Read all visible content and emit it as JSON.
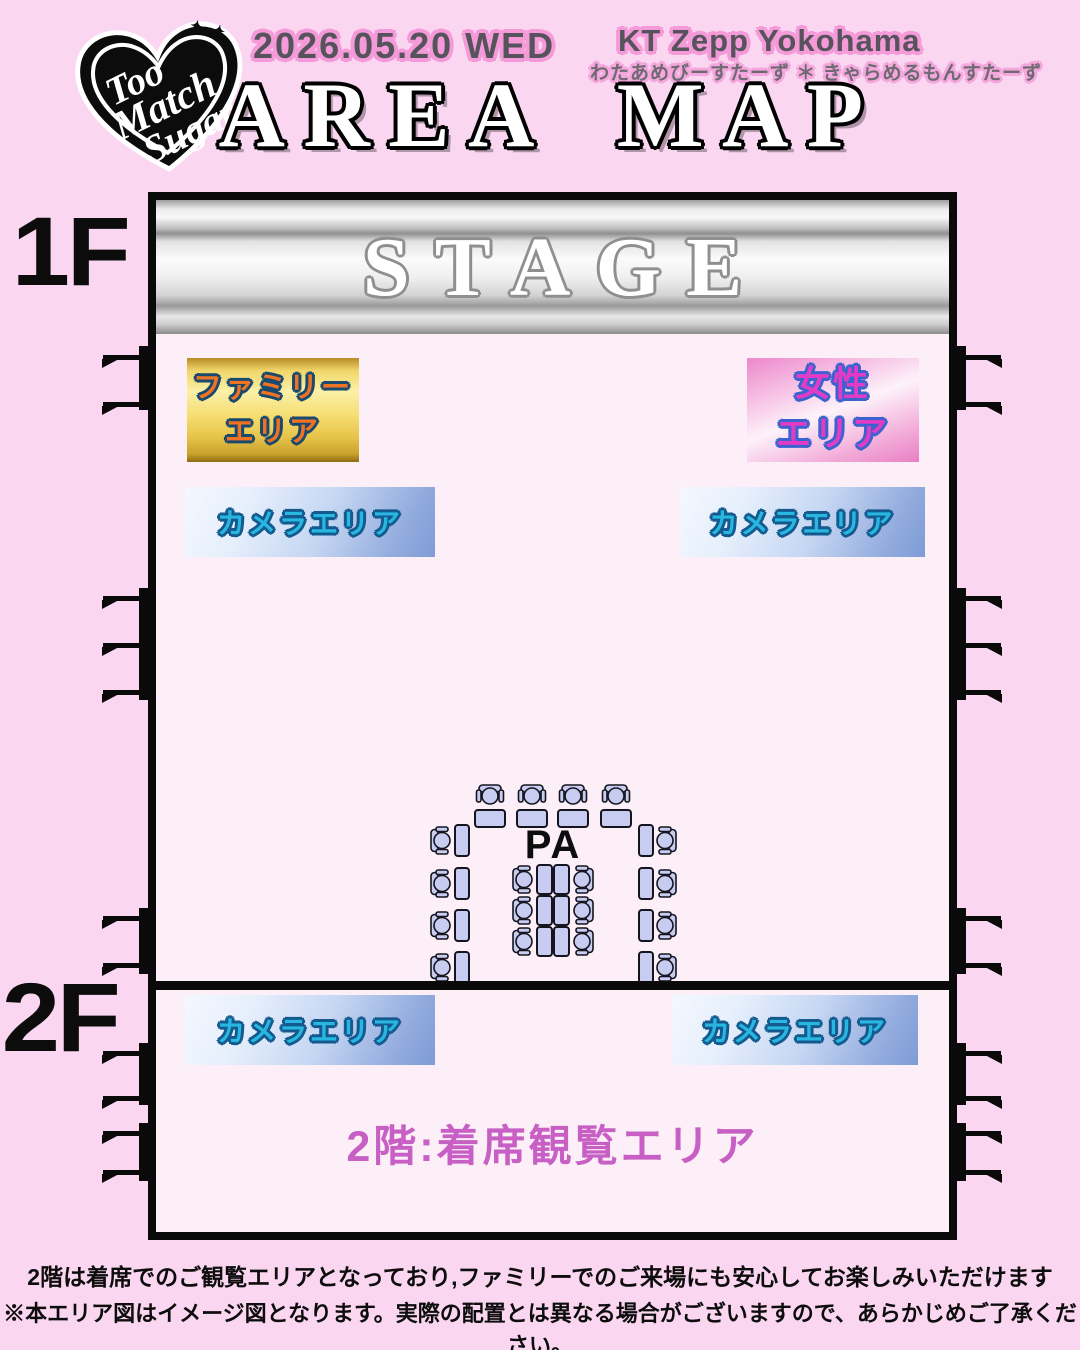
{
  "logo": {
    "lines": [
      "Too",
      "Match",
      "Sugar"
    ],
    "sparkles": "✦ ✦"
  },
  "header": {
    "date": "2026.05.20 WED",
    "venue": "KT Zepp Yokohama",
    "artists": "わたあめびーすたーず ＊ きゃらめるもんすたーず",
    "title": "AREA MAP"
  },
  "map": {
    "floor1_label": "1F",
    "floor2_label": "2F",
    "stage_label": "STAGE",
    "family_area": {
      "line1": "ファミリー",
      "line2": "エリア"
    },
    "women_area": {
      "line1": "女性",
      "line2": "エリア"
    },
    "camera_area_label": "カメラエリア",
    "pa_label": "PA",
    "floor2_seating_label": "2階:着席観覧エリア"
  },
  "footer": {
    "line1": "2階は着席でのご観覧エリアとなっており,ファミリーでのご来場にも安心してお楽しみいただけます",
    "line2": "※本エリア図はイメージ図となります。実際の配置とは異なる場合がございますので、あらかじめご了承ください。"
  },
  "colors": {
    "background": "#fad6f0",
    "venue_interior": "#fdeff8",
    "wall": "#0a0a0a",
    "gold_area": "#f5dd70",
    "women_area_pink": "#f3aeda",
    "camera_area_blue": "#92abde",
    "family_text": "#ef7323",
    "women_text": "#e23cc6",
    "camera_text": "#27b7e0",
    "seating_text": "#c75fc5",
    "seat_fill": "#c7ccf0",
    "header_halo": "#f59ad8"
  }
}
